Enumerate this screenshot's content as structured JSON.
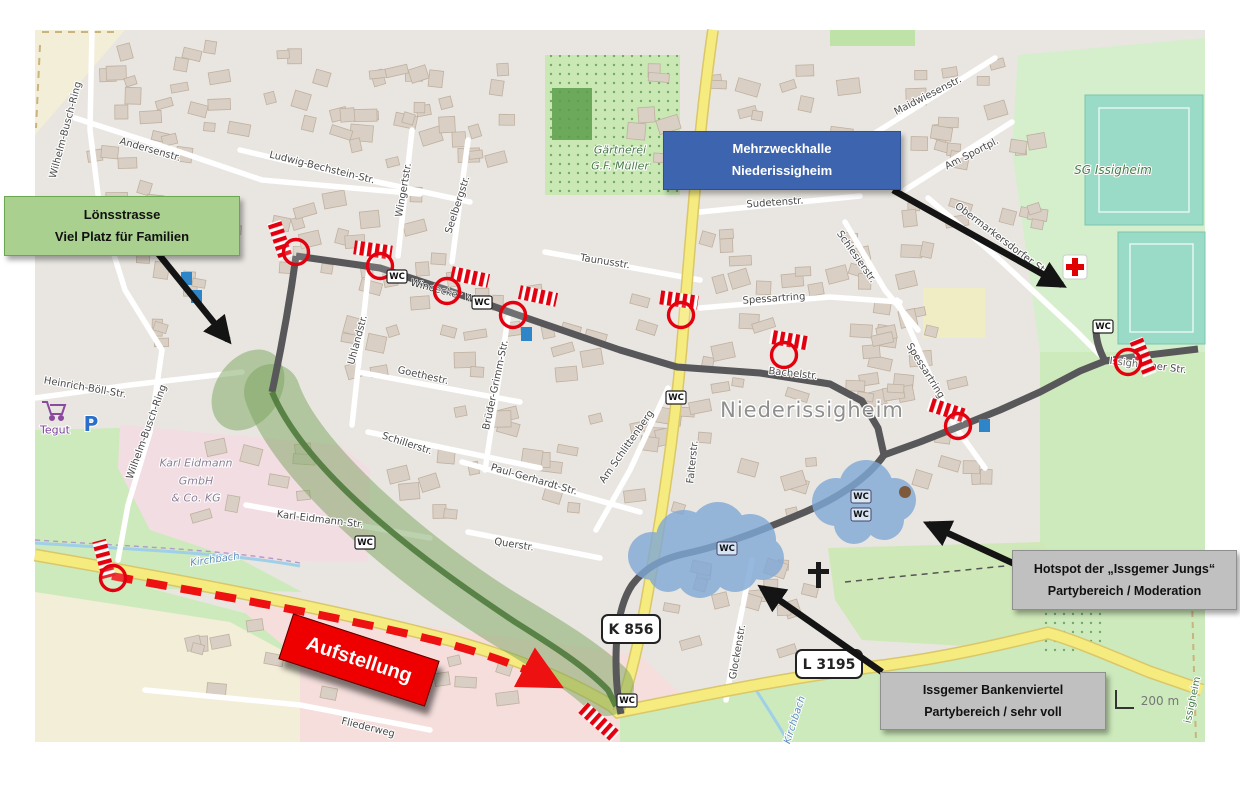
{
  "annotations": {
    "loensstrasse": {
      "line1": "Lönsstrasse",
      "line2": "Viel Platz für Familien"
    },
    "mehrzweckhalle": {
      "line1": "Mehrzweckhalle",
      "line2": "Niederissigheim"
    },
    "hotspot": {
      "line1": "Hotspot der „Issgemer Jungs“",
      "line2": "Partybereich / Moderation"
    },
    "bankenviertel": {
      "line1": "Issgemer Bankenviertel",
      "line2": "Partybereich / sehr voll"
    },
    "aufstellung": {
      "label": "Aufstellung"
    }
  },
  "map": {
    "place_label": "Niederissigheim",
    "wc_label": "WC",
    "scale_label": "200 m",
    "shields": {
      "k856": "K 856",
      "l3195": "L 3195"
    },
    "pois": {
      "gaertnerei_line1": "Gärtnerei",
      "gaertnerei_line2": "G.F. Müller",
      "sg_issigheim": "SG Issigheim",
      "tegut": "Tegut",
      "parking": "P",
      "karl_line1": "Karl Eidmann",
      "karl_line2": "GmbH",
      "karl_line3": "& Co. KG",
      "kirchbach": "Kirchbach"
    },
    "streets": [
      "Wilhelm-Busch-Ring",
      "Andersenstr.",
      "Ludwig-Bechstein-Str.",
      "Wingertstr.",
      "Seelbergstr.",
      "Sudetenstr.",
      "Maidwiesenstr.",
      "Am Sportpl.",
      "Obermarkersdorfer Str.",
      "Schlesierstr.",
      "Taunusstr.",
      "Spessartring",
      "Spessartring",
      "Uhlandstr.",
      "Goethestr.",
      "Schillerstr.",
      "Brüder-Grimm-Str.",
      "Paul-Gerhardt-Str.",
      "Am Schlittenberg",
      "Querstr.",
      "Falterstr.",
      "Bachelstr.",
      "Heinrich-Böll-Str.",
      "Wilhelm-Busch-Ring",
      "Karl-Eidmann-Str.",
      "Glockenstr.",
      "Fliederweg",
      "Issigheimer Str.",
      "Windecker Weg",
      "issigheim"
    ]
  },
  "colors": {
    "route_gray": "#58585a",
    "family_zone_green": "#79a35e",
    "party_cloud_blue": "#7fa8d6",
    "barrier_red": "#e3000f",
    "label_green_bg": "#a9d08e",
    "label_blue_bg": "#3d64ae",
    "label_gray_bg": "#c0c0c0",
    "aufstellung_red": "#ee0000",
    "main_road_yellow": "#f6eb7e"
  }
}
